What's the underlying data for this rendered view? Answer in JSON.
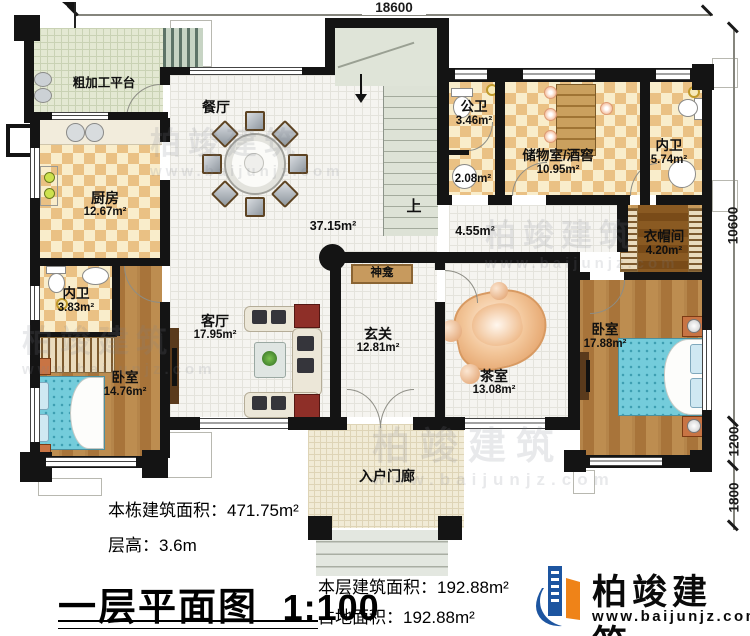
{
  "dims": {
    "top": "18600",
    "right_a": "10600",
    "right_b": "1200",
    "right_c": "1800"
  },
  "rooms": {
    "platform": {
      "name": "粗加工平台"
    },
    "kitchen": {
      "name": "厨房",
      "area": "12.67m²"
    },
    "dining": {
      "name": "餐厅",
      "area": "37.15m²"
    },
    "stairs": {
      "up": "上"
    },
    "hall": {
      "area": "4.55m²"
    },
    "public_bath": {
      "name": "公卫",
      "area": "3.46m²"
    },
    "wash": {
      "area": "2.08m²"
    },
    "storage": {
      "name": "储物室/酒窖",
      "area": "10.95m²"
    },
    "inner_bath_right": {
      "name": "内卫",
      "area": "5.74m²"
    },
    "cloakroom": {
      "name": "衣帽间",
      "area": "4.20m²"
    },
    "bedroom_right": {
      "name": "卧室",
      "area": "17.88m²"
    },
    "tea": {
      "name": "茶室",
      "area": "13.08m²"
    },
    "foyer": {
      "name": "玄关",
      "area": "12.81m²"
    },
    "shrine": {
      "name": "神龛"
    },
    "living": {
      "name": "客厅",
      "area": "17.95m²"
    },
    "inner_bath_left": {
      "name": "内卫",
      "area": "3.83m²"
    },
    "bedroom_left": {
      "name": "卧室",
      "area": "14.76m²"
    },
    "porch": {
      "name": "入户门廊"
    }
  },
  "info": {
    "building_area_label": "本栋建筑面积：",
    "building_area_value": "471.75m²",
    "floor_height_label": "层高：",
    "floor_height_value": "3.6m",
    "plan_title": "一层平面图",
    "plan_scale": "1:100",
    "floor_area_label": "本层建筑面积：",
    "floor_area_value": "192.88m²",
    "footprint_label": "占地面积：",
    "footprint_value": "192.88m²"
  },
  "brand": {
    "name": "柏竣建筑",
    "website": "www.baijunjz.com",
    "blue": "#1d55a0",
    "orange": "#ef8318"
  },
  "watermark": {
    "name": "柏竣建筑",
    "website": "www.baijunjz.com"
  }
}
